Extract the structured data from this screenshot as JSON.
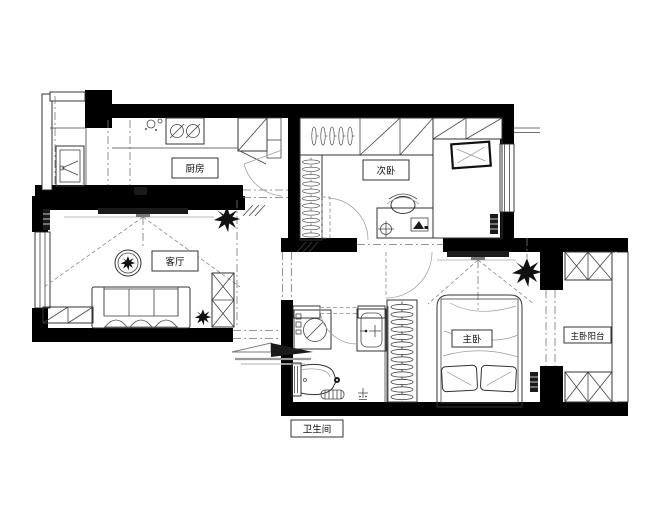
{
  "plan": {
    "rooms": {
      "kitchen": {
        "label": "厨房"
      },
      "second_bedroom": {
        "label": "次卧"
      },
      "living_room": {
        "label": "客厅"
      },
      "master_bedroom": {
        "label": "主卧"
      },
      "master_balcony": {
        "label": "主卧阳台"
      },
      "bathroom": {
        "label": "卫生间"
      }
    },
    "colors": {
      "wall": "#000000",
      "line": "#333333",
      "background": "#ffffff"
    },
    "furniture": {
      "kitchen": [
        "sink",
        "stove",
        "hob",
        "fridge",
        "pantry",
        "counter"
      ],
      "second_bedroom": [
        "wardrobe-hangers",
        "closet-shelves",
        "tatami-bed",
        "pillow",
        "desk",
        "chair",
        "desk-lamp",
        "laptop",
        "radiator"
      ],
      "living_room": [
        "tv",
        "tv-console",
        "ceiling-lamp",
        "sofa",
        "shoe-cabinet",
        "low-cabinet",
        "plant",
        "radiator"
      ],
      "bathroom": [
        "washing-machine",
        "wash-basin",
        "toilet",
        "floor-drain",
        "bath-mat",
        "shower-drain"
      ],
      "master_bedroom": [
        "double-bed",
        "pillows",
        "wardrobe-hangers",
        "tv",
        "pendant-plant",
        "radiator"
      ],
      "master_balcony": [
        "storage-cabinet-top",
        "storage-cabinet-bottom"
      ]
    }
  }
}
